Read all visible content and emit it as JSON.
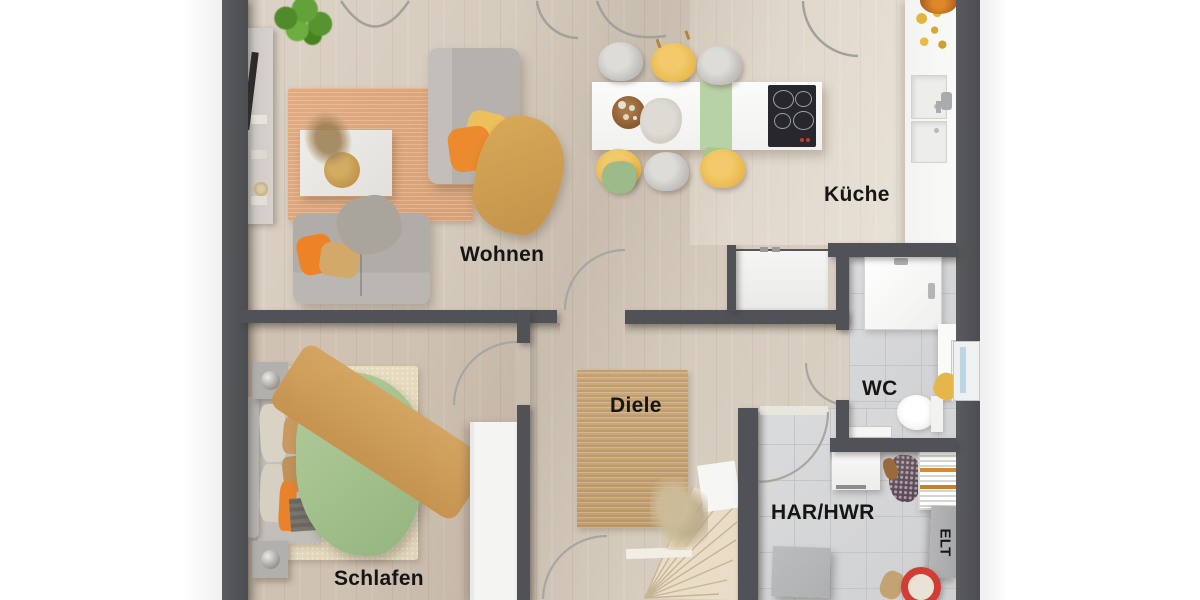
{
  "rooms": {
    "wohnen": {
      "label": "Wohnen"
    },
    "kueche": {
      "label": "Küche"
    },
    "wc": {
      "label": "WC"
    },
    "diele": {
      "label": "Diele"
    },
    "har_hwr": {
      "label": "HAR/HWR"
    },
    "schlafen": {
      "label": "Schlafen"
    },
    "elt": {
      "label": "ELT"
    }
  },
  "colors": {
    "wall": "#515257",
    "wood_floor": "#d7ccbf",
    "tile_floor": "#d6d7d9",
    "outside": "#ffffff",
    "rug_living": "#e0a478",
    "rug_diele": "#c8a476",
    "rug_bed": "#e5dac1",
    "accent_orange": "#ec8428",
    "accent_yellow": "#eec35e",
    "accent_green": "#a9c493",
    "label_text": "#151515"
  },
  "furniture": [
    "tv-sideboard",
    "potted-plant",
    "living-rug",
    "coffee-table",
    "sofa",
    "chaise-sofa",
    "kitchen-island",
    "cooktop",
    "dining-chairs",
    "table-runner",
    "kitchen-counter",
    "sink",
    "fridge-cabinet",
    "shower",
    "toilet",
    "towel-radiator",
    "bathroom-window",
    "bed",
    "wardrobe",
    "nightstands",
    "hall-rug",
    "winder-stairs",
    "washing-machine",
    "drying-rack",
    "storage-box",
    "electrical-cabinet",
    "bucket"
  ]
}
